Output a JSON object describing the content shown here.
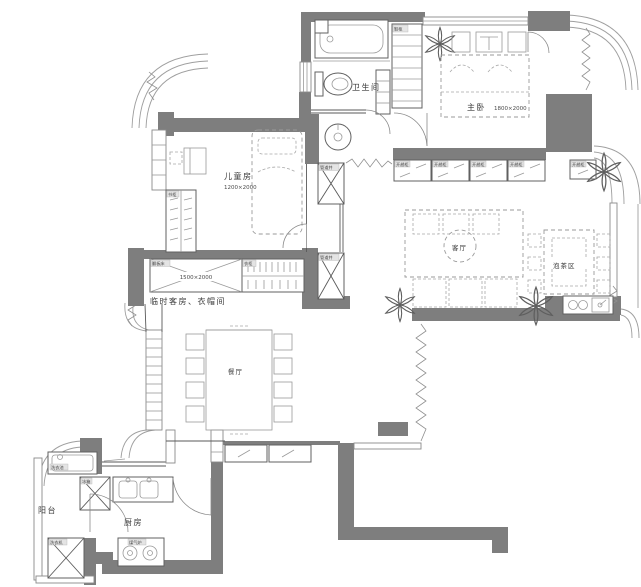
{
  "plan": {
    "background": "#ffffff",
    "wall_color": "#7e7e7e",
    "rooms": {
      "bathroom": {
        "label": "卫生间"
      },
      "master": {
        "label": "主卧",
        "dim": "1800×2000"
      },
      "kids": {
        "label": "儿童房",
        "dim": "1200×2000"
      },
      "living": {
        "label": "客厅"
      },
      "tea": {
        "label": "泡茶区"
      },
      "guest": {
        "label": "临时客房、衣帽间",
        "bed_dim": "1500×2000",
        "bed_tag": "翻板床",
        "wardrobe_tag": "衣柜"
      },
      "dining": {
        "label": "餐厅"
      },
      "kitchen": {
        "label": "厨房",
        "fridge_tag": "冰箱",
        "stove_tag": "煤气炉"
      },
      "balcony": {
        "label": "阳台",
        "sink_tag": "洗衣池",
        "washer_tag": "洗衣机"
      }
    },
    "tags": {
      "wardrobe_cabinet": "开趟柜",
      "shoe_cabinet": "鞋柜",
      "bookcase": "书柜",
      "shaft": "管道井"
    }
  }
}
